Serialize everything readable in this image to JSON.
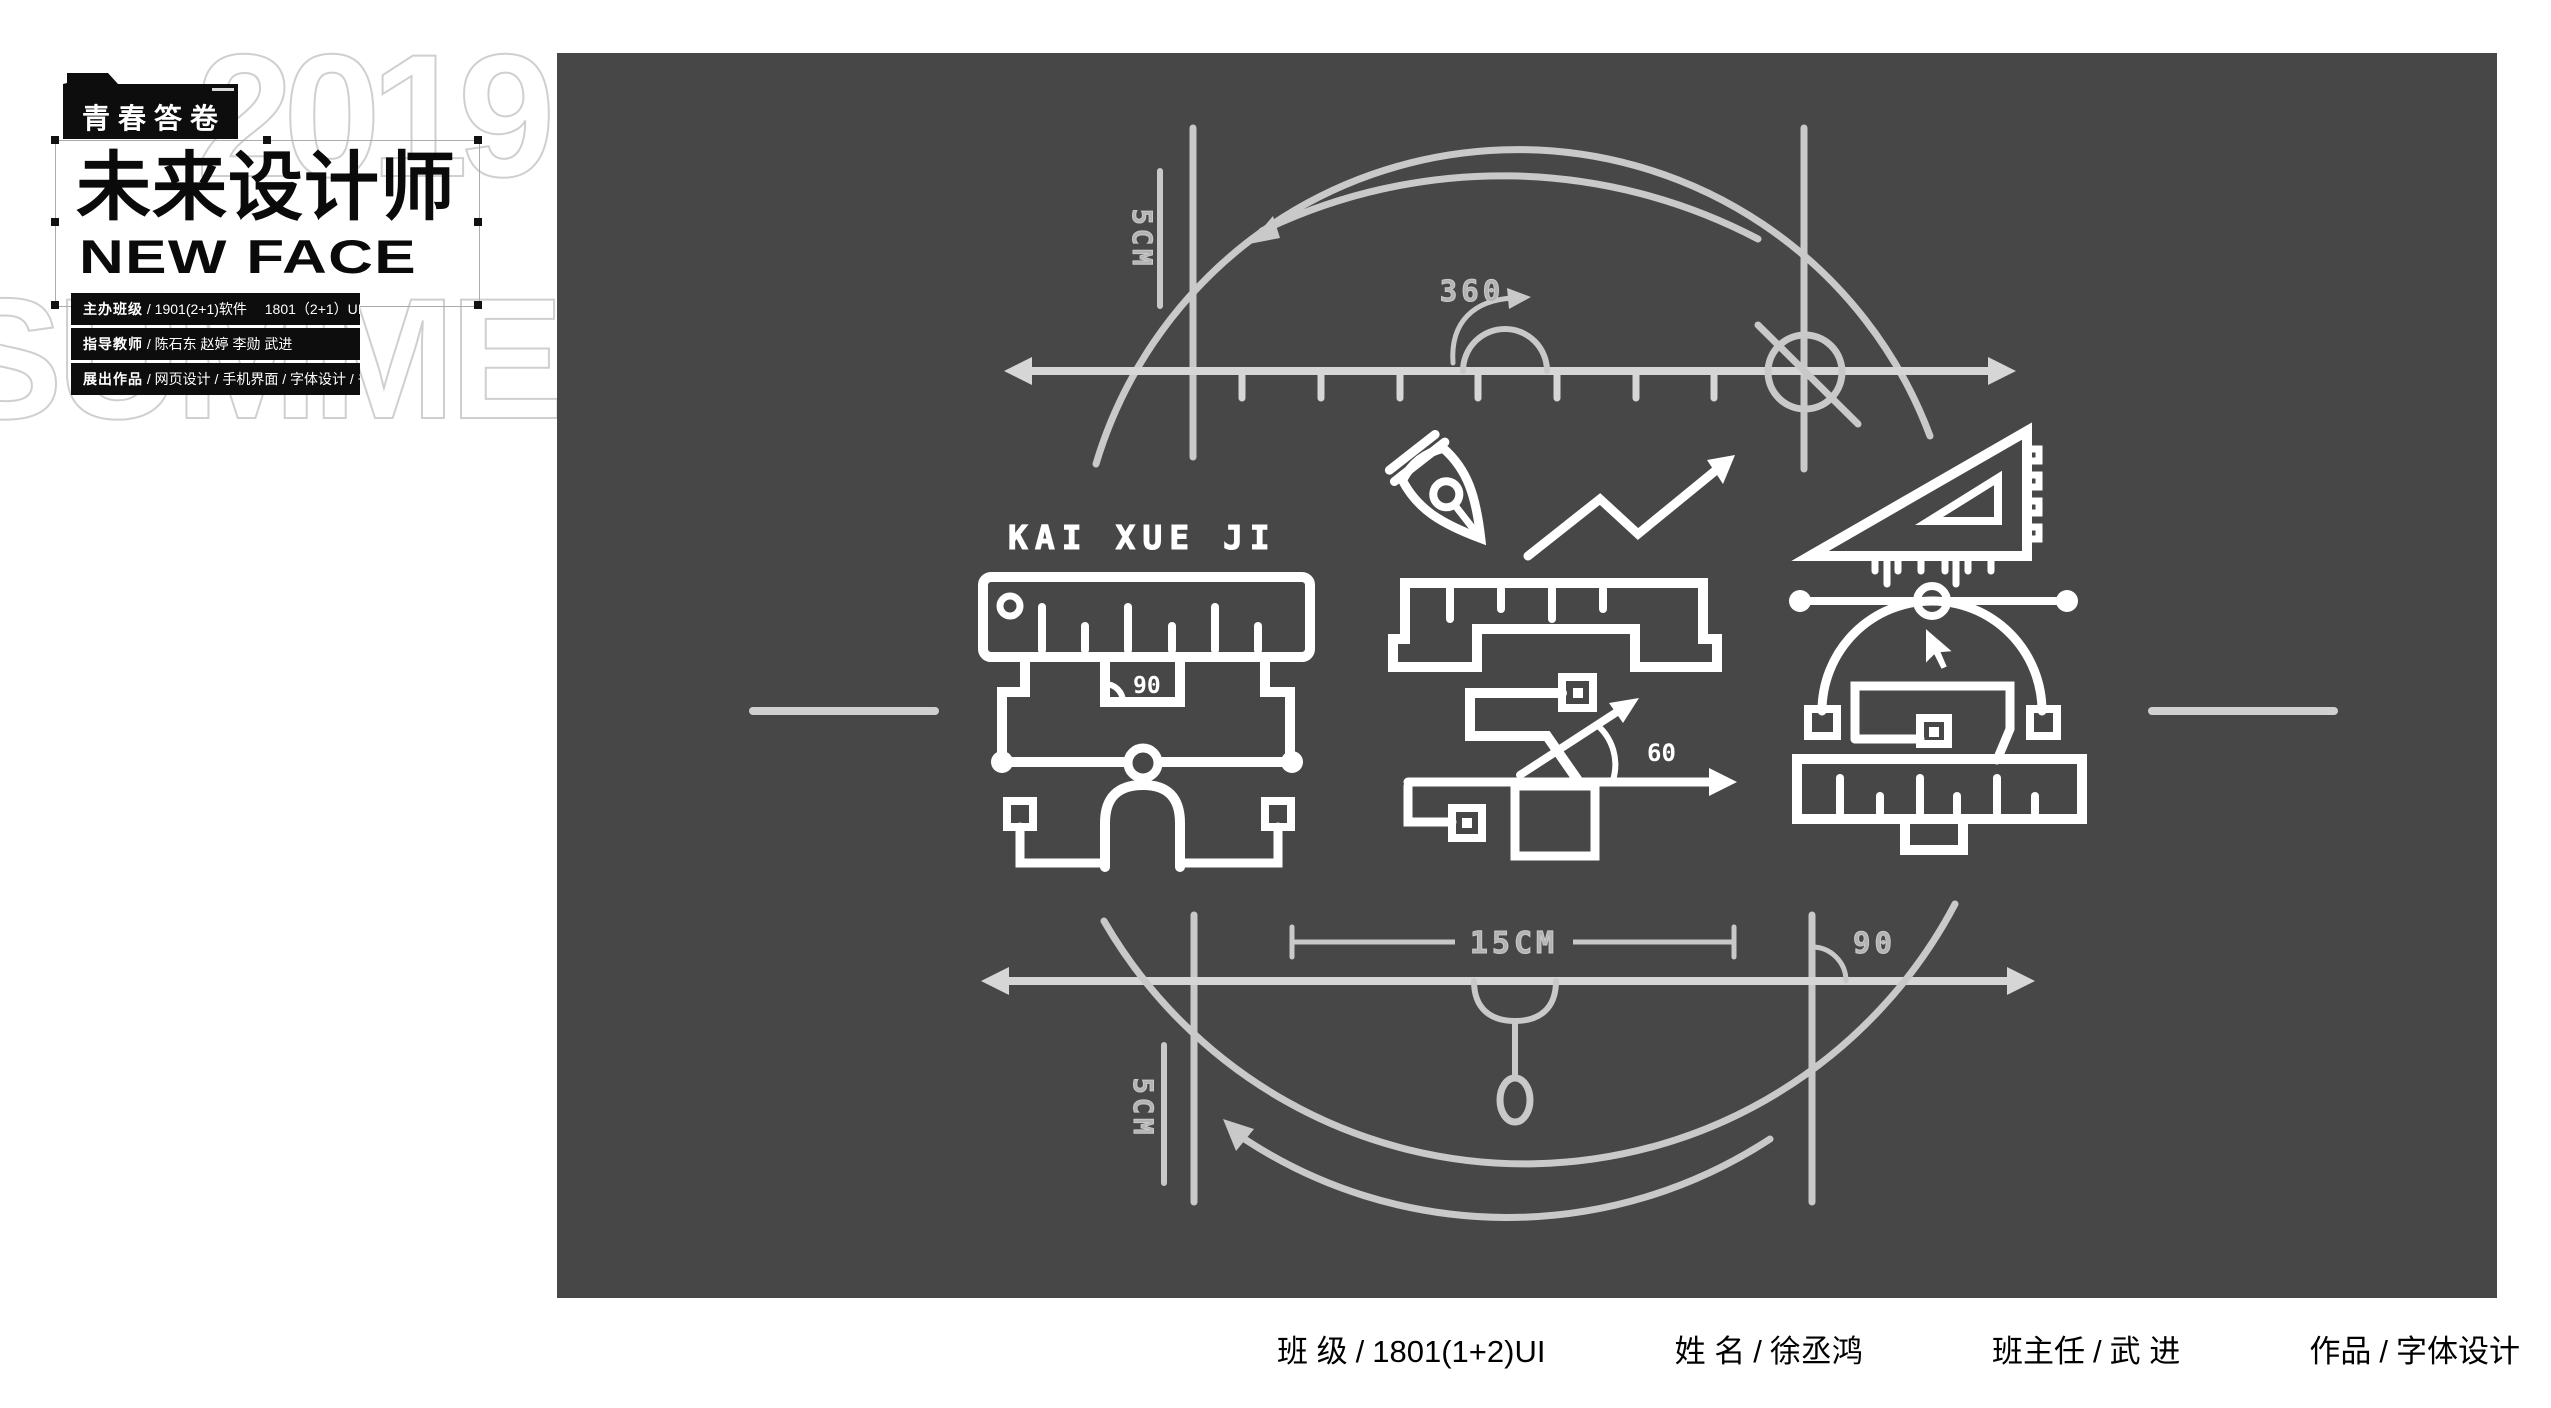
{
  "logo": {
    "folder_label": "青春答卷",
    "title_cn": "未来设计师",
    "title_en": "NEW FACE",
    "ghost_year": "2019",
    "ghost_word": "SUMMER",
    "info_bars": [
      {
        "label": "主办班级",
        "text": "/ 1901(2+1)软件　 1801（2+1）UI"
      },
      {
        "label": "指导教师",
        "text": "/ 陈石东  赵婷  李勋  武进"
      },
      {
        "label": "展出作品",
        "text": "/ 网页设计 / 手机界面 / 字体设计 / 书籍封面"
      }
    ]
  },
  "artboard": {
    "background": "#474747",
    "glyph_color": "#ffffff",
    "guide_color": "#c9c9c9",
    "axis_color": "#d6d6d6",
    "label_color": "#b3b3b3",
    "labels": {
      "top_margin": "5CM",
      "rotation": "360",
      "pinyin": "KAI XUE JI",
      "glyph_angle": "90",
      "diagonal_angle": "60",
      "width_dim": "15CM",
      "right_angle": "90",
      "bottom_margin": "5CM"
    }
  },
  "caption": {
    "separator": "/",
    "items": [
      {
        "label": "班 级",
        "value": "1801(1+2)UI"
      },
      {
        "label": "姓  名",
        "value": "徐丞鸿"
      },
      {
        "label": "班主任",
        "value": "武 进"
      },
      {
        "label": "作品",
        "value": "字体设计"
      }
    ]
  }
}
